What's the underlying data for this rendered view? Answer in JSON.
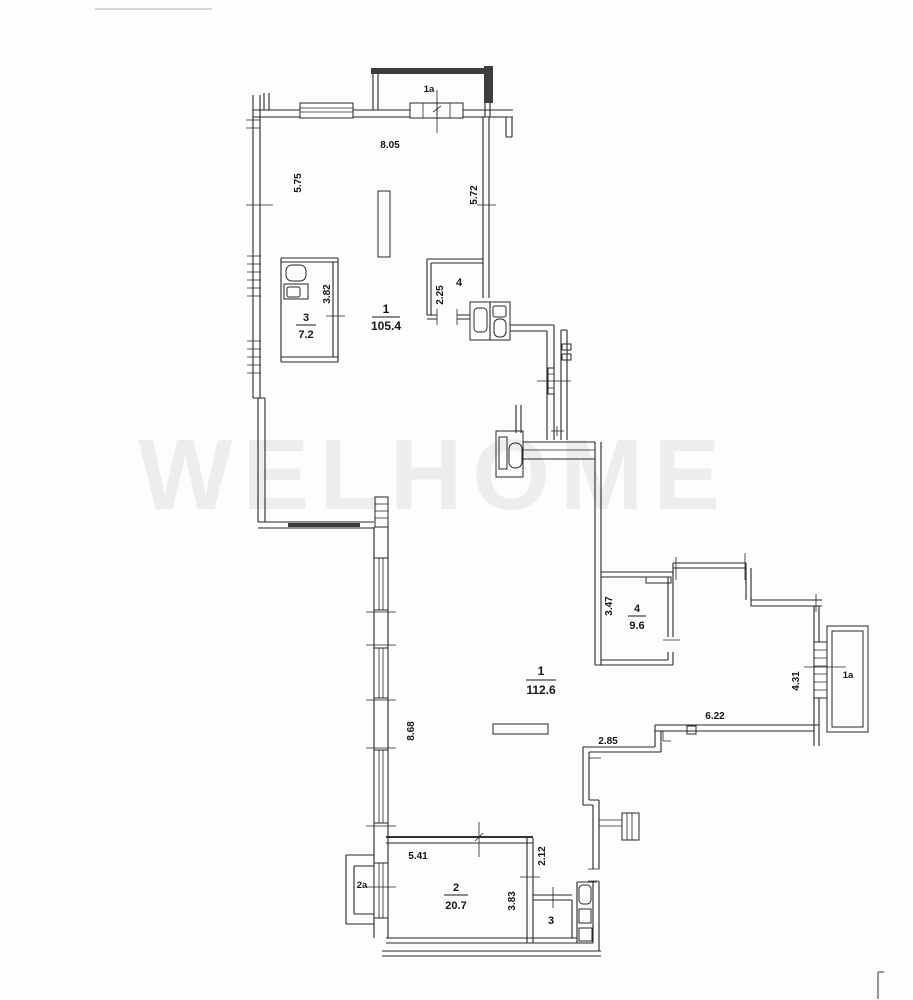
{
  "watermark": {
    "text": "WELHOME"
  },
  "colors": {
    "ink": "#1c1c1c",
    "wall_fill": "#3d3d3d",
    "watermark": "#8a8585"
  },
  "plan": {
    "upper": {
      "balcony_label": "1a",
      "dim_width": "8.05",
      "dim_left": "5.75",
      "dim_right": "5.72",
      "room1": {
        "num": "1",
        "area": "105.4"
      },
      "room3": {
        "num": "3",
        "area": "7.2",
        "dim": "3.82"
      },
      "room4": {
        "num": "4",
        "dim": "2.25"
      }
    },
    "lower": {
      "room1": {
        "num": "1",
        "area": "112.6"
      },
      "room2": {
        "num": "2",
        "area": "20.7",
        "dim_top": "5.41",
        "dim_right": "2.12",
        "dim_inner": "3.83"
      },
      "room3": {
        "num": "3"
      },
      "room4": {
        "num": "4",
        "area": "9.6",
        "dim": "3.47"
      },
      "balcony_right": {
        "label": "1a",
        "dim": "4.31"
      },
      "balcony_left": {
        "label": "2a"
      },
      "dim_left": "8.68",
      "dim_wing": "6.22",
      "dim_step": "2.85"
    }
  }
}
